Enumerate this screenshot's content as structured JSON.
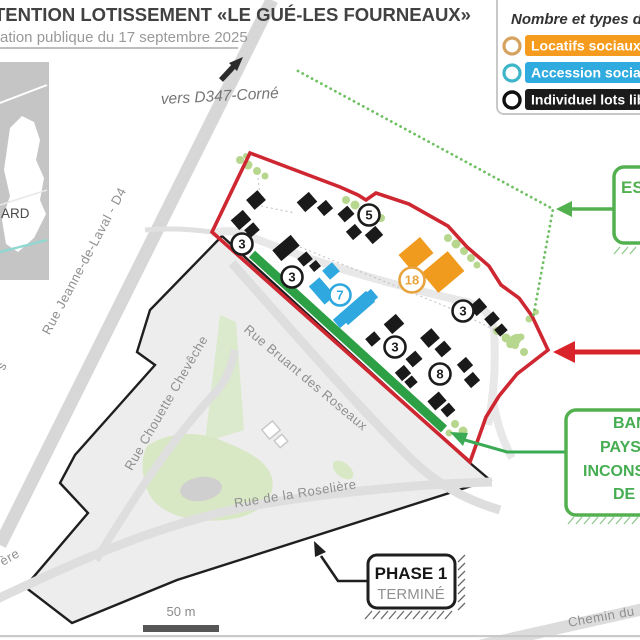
{
  "header": {
    "title": "TENTION LOTISSEMENT «LE GUÉ-LES FOURNEAUX»",
    "subtitle": "ation publique du 17 septembre 2025"
  },
  "legend": {
    "title": "Nombre et types d",
    "items": [
      {
        "label": "Locatifs sociaux",
        "pill_color": "#f59c1e",
        "ring_color": "#d6a260"
      },
      {
        "label": "Accession sociale",
        "pill_color": "#2fabdf",
        "ring_color": "#3eb5c8"
      },
      {
        "label": "Individuel lots libr",
        "pill_color": "#1b1b1b",
        "ring_color": "#101010"
      }
    ]
  },
  "map": {
    "direction_label": "vers D347-Corné",
    "minimap_label": "ARD",
    "streets": {
      "jeanne": "Rue Jeanne-de-Laval - D4",
      "chouette": "Rue Chouette Chevêche",
      "bruant": "Rue Bruant des Roseaux",
      "roseliere": "Rue de la Roselière",
      "chemin": "Chemin du",
      "stray1": "s",
      "stray2": "ère"
    },
    "lot_counts": [
      {
        "value": "3",
        "category": "individuel",
        "color": "#1c1c1c"
      },
      {
        "value": "5",
        "category": "individuel",
        "color": "#1c1c1c"
      },
      {
        "value": "3",
        "category": "individuel",
        "color": "#1c1c1c"
      },
      {
        "value": "7",
        "category": "accession-sociale",
        "color": "#2fa8df"
      },
      {
        "value": "18",
        "category": "locatifs-sociaux",
        "color": "#e8a33d"
      },
      {
        "value": "3",
        "category": "individuel",
        "color": "#1c1c1c"
      },
      {
        "value": "3",
        "category": "individuel",
        "color": "#1c1c1c"
      },
      {
        "value": "8",
        "category": "individuel",
        "color": "#1c1c1c"
      }
    ],
    "callouts": {
      "espace": {
        "line1": "ESP"
      },
      "bande": {
        "line1": "BAN",
        "line2": "PAYSA",
        "line3": "INCONSTR",
        "line4": "DE"
      },
      "phase": {
        "line1": "PHASE 1",
        "line2": "TERMINÉ"
      }
    },
    "scale_label": "50 m"
  },
  "colors": {
    "boundary_red": "#ce2731",
    "accent_green": "#53b04f",
    "green_strip": "#2d9f44",
    "locatifs_orange": "#f09a1e",
    "accession_blue": "#2fa8df",
    "individuel_black": "#1a1a1a",
    "phase1_fill": "#ededed",
    "road_grey": "#d7d7d7"
  }
}
